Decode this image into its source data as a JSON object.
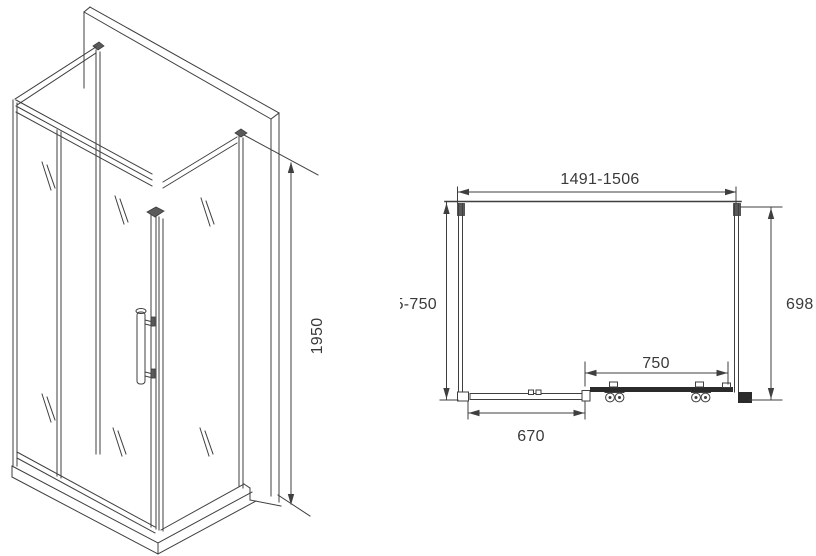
{
  "isometric_view": {
    "height_label": "1950"
  },
  "plan_view": {
    "width_label": "1491-1506",
    "depth_label": "735-750",
    "side_panel_label": "698",
    "door_label": "750",
    "fixed_panel_label": "670"
  },
  "colors": {
    "line": "#3f3f3f",
    "text": "#3a3a3a",
    "solid_fill": "#2b2b2b",
    "background": "#ffffff"
  }
}
